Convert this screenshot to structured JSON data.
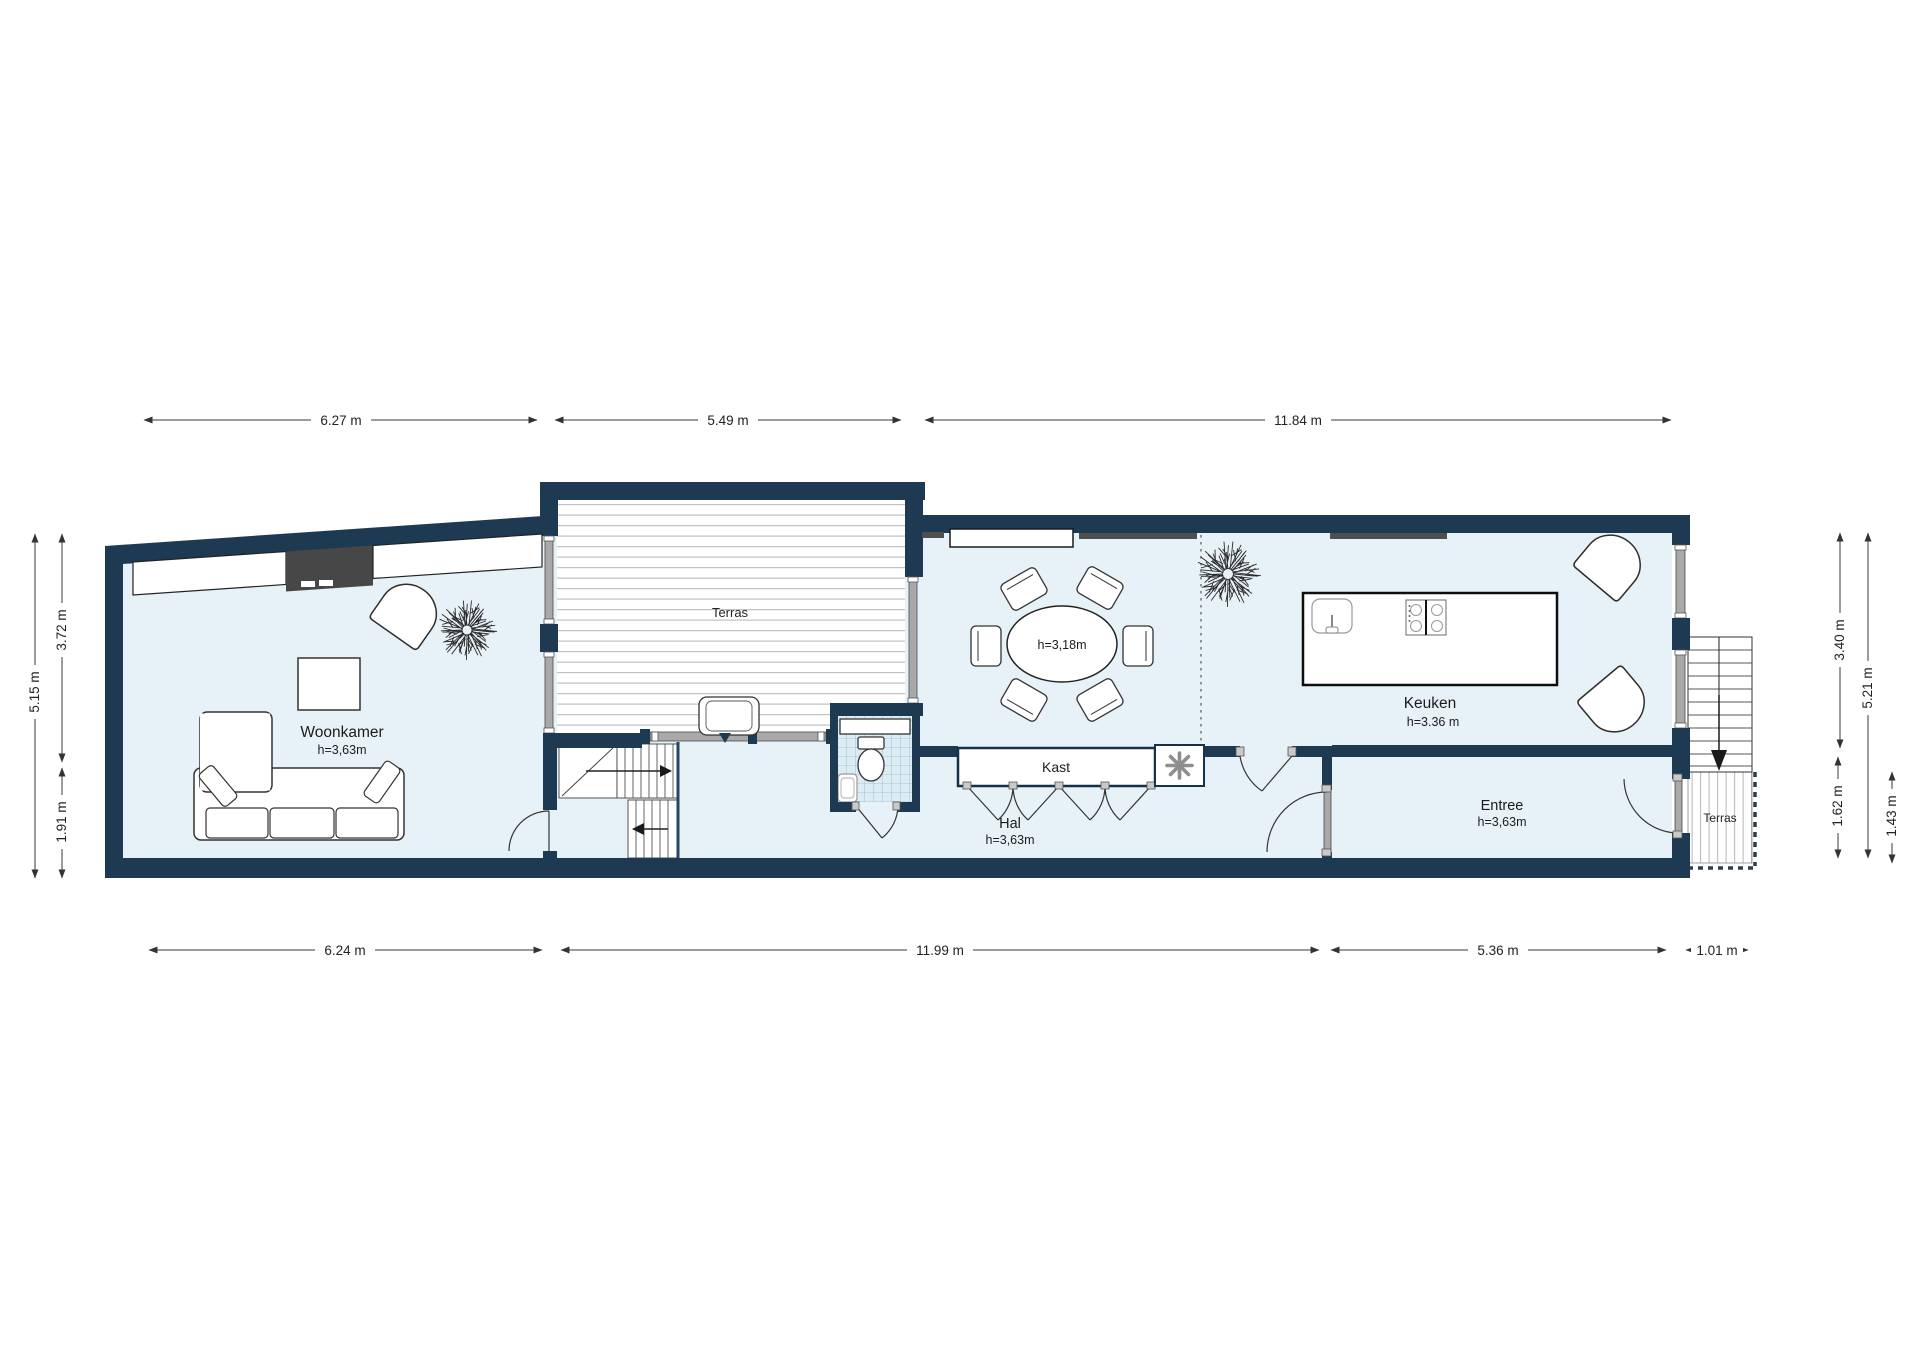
{
  "rooms": {
    "woonkamer": {
      "label": "Woonkamer",
      "height": "h=3,63m"
    },
    "terras_main": {
      "label": "Terras"
    },
    "dining": {
      "height": "h=3,18m"
    },
    "keuken": {
      "label": "Keuken",
      "height": "h=3.36 m"
    },
    "kast": {
      "label": "Kast"
    },
    "hal": {
      "label": "Hal",
      "height": "h=3,63m"
    },
    "entree": {
      "label": "Entree",
      "height": "h=3,63m"
    },
    "terras_right": {
      "label": "Terras"
    }
  },
  "dimensions": {
    "top": [
      {
        "label": "6.27 m"
      },
      {
        "label": "5.49 m"
      },
      {
        "label": "11.84 m"
      }
    ],
    "bottom": [
      {
        "label": "6.24 m"
      },
      {
        "label": "11.99 m"
      },
      {
        "label": "5.36 m"
      },
      {
        "label": "1.01 m"
      }
    ],
    "left": [
      {
        "label": "5.15 m"
      },
      {
        "label": "3.72 m"
      },
      {
        "label": "1.91 m"
      }
    ],
    "right": [
      {
        "label": "3.40 m"
      },
      {
        "label": "5.21 m"
      },
      {
        "label": "1.62 m"
      },
      {
        "label": "1.43 m"
      }
    ]
  },
  "colors": {
    "wall": "#1d3a52",
    "floor": "#e7f2f8",
    "deck_line": "#c2c2c2",
    "tile_bg": "#dcecf4",
    "tile_line": "#9db7c7",
    "radiator": "#4f4f4f",
    "fireplace": "#474747"
  }
}
